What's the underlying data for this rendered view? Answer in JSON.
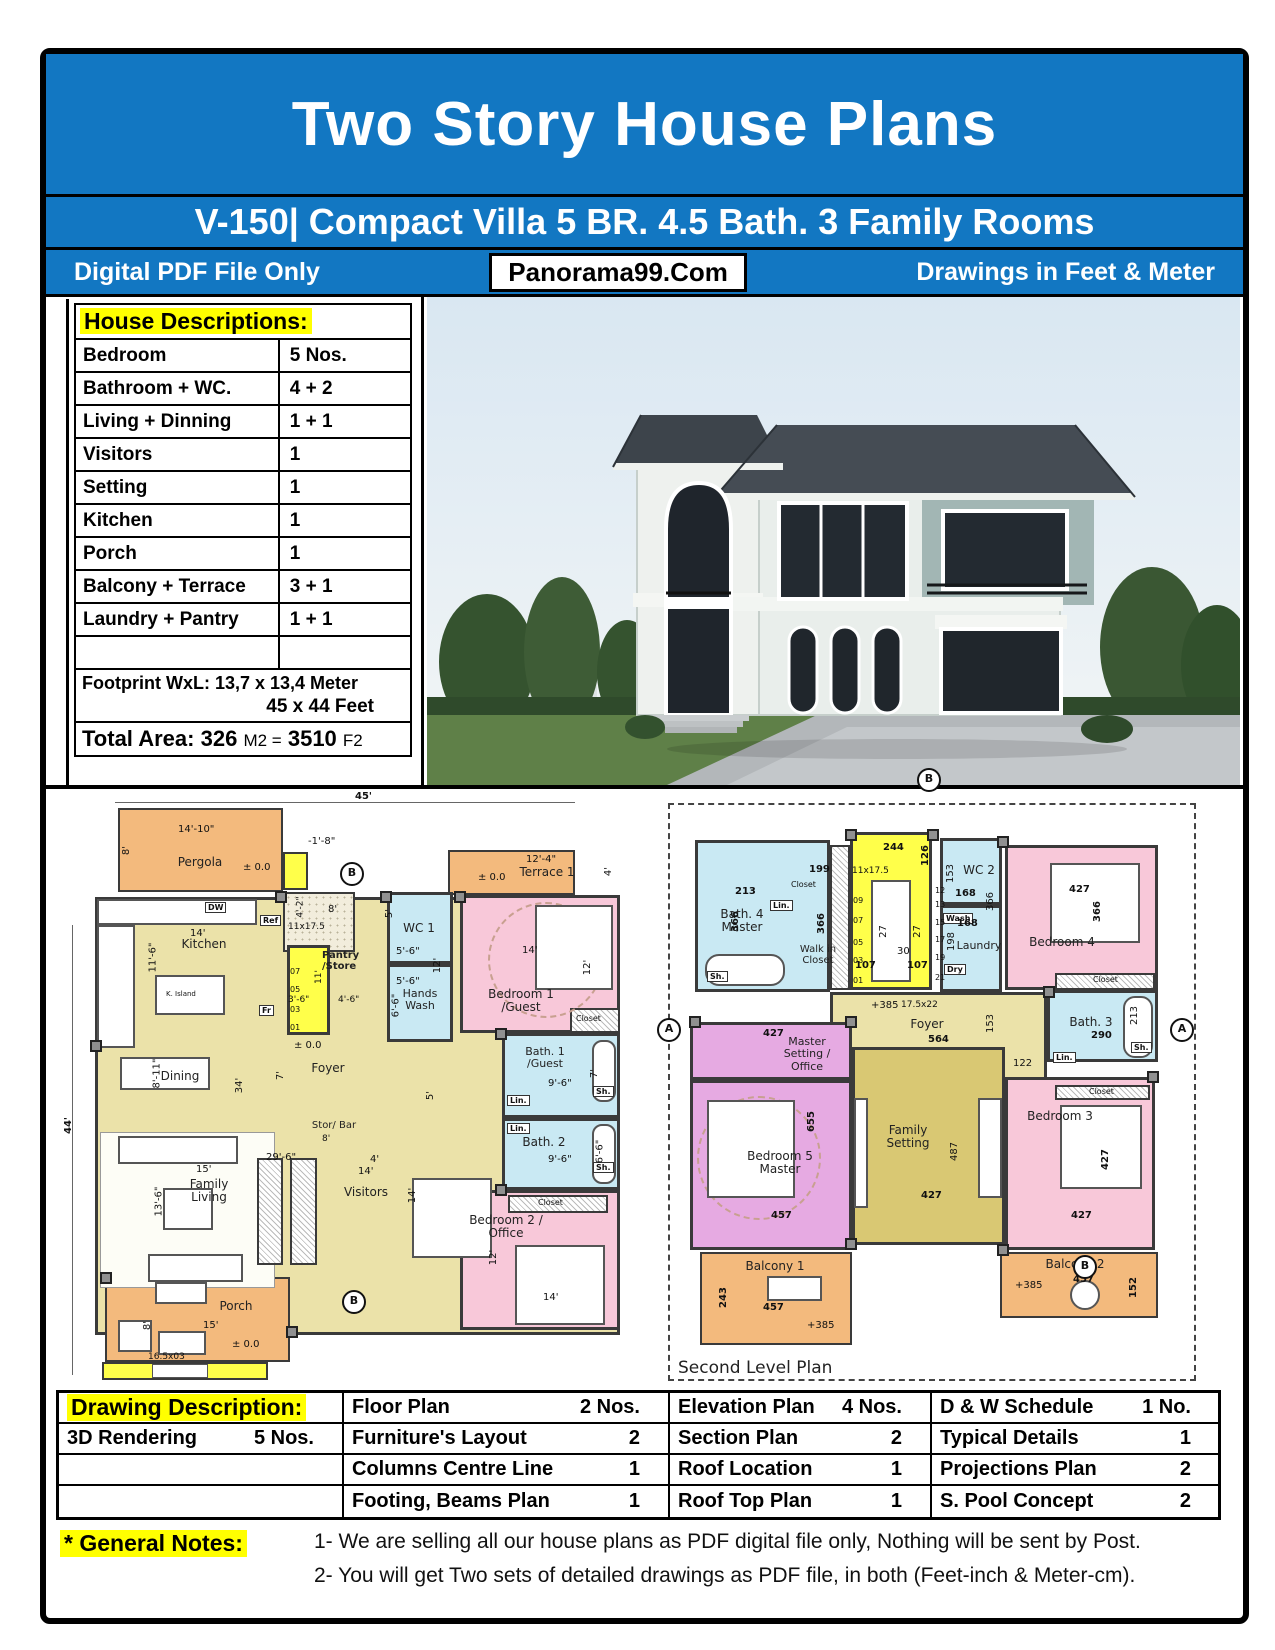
{
  "header": {
    "title": "Two Story House Plans",
    "subtitle": "V-150| Compact Villa 5 BR. 4.5 Bath. 3 Family Rooms",
    "left_note": "Digital PDF File Only",
    "site": "Panorama99.Com",
    "right_note": "Drawings in Feet & Meter"
  },
  "house": {
    "title": "House Descriptions:",
    "rows": [
      {
        "label": "Bedroom",
        "value": "5 Nos."
      },
      {
        "label": "Bathroom + WC.",
        "value": "4 + 2"
      },
      {
        "label": "Living + Dinning",
        "value": "1 + 1"
      },
      {
        "label": "Visitors",
        "value": "1"
      },
      {
        "label": "Setting",
        "value": "1"
      },
      {
        "label": "Kitchen",
        "value": "1"
      },
      {
        "label": "Porch",
        "value": "1"
      },
      {
        "label": "Balcony + Terrace",
        "value": "3  + 1"
      },
      {
        "label": "Laundry + Pantry",
        "value": "1  + 1"
      },
      {
        "label": "",
        "value": ""
      }
    ],
    "footprint_line1": "Footprint WxL: 13,7 x 13,4 Meter",
    "footprint_line2": "45 x 44 Feet",
    "total_label": "Total Area:",
    "total_m2": "326",
    "total_m2_unit": "M2 =",
    "total_f2": "3510",
    "total_f2_unit": "F2"
  },
  "drawing": {
    "title": "Drawing Description:",
    "rows": [
      {
        "c1l": "",
        "c1v": "",
        "c2l": "Floor Plan",
        "c2v": "2 Nos.",
        "c3l": "Elevation Plan",
        "c3v": "4 Nos.",
        "c4l": "D & W Schedule",
        "c4v": "1 No."
      },
      {
        "c1l": "3D Rendering",
        "c1v": "5 Nos.",
        "c2l": "Furniture's Layout",
        "c2v": "2",
        "c3l": "Section Plan",
        "c3v": "2",
        "c4l": "Typical Details",
        "c4v": "1"
      },
      {
        "c1l": "",
        "c1v": "",
        "c2l": "Columns Centre Line",
        "c2v": "1",
        "c3l": "Roof Location",
        "c3v": "1",
        "c4l": "Projections Plan",
        "c4v": "2"
      },
      {
        "c1l": "",
        "c1v": "",
        "c2l": "Footing, Beams Plan",
        "c2v": "1",
        "c3l": "Roof Top Plan",
        "c3v": "1",
        "c4l": "S. Pool Concept",
        "c4v": "2"
      }
    ]
  },
  "notes": {
    "title": "* General Notes:",
    "line1": "1- We are selling all our house plans as PDF digital file only, Nothing will be sent by Post.",
    "line2": "2- You will get Two sets of detailed drawings as PDF file, in both (Feet-inch & Meter-cm)."
  },
  "rooms1": {
    "pergola": "Pergola",
    "terrace": "Terrace 1",
    "kitchen": "Kitchen",
    "pantry": "Pantry /Store",
    "wc1": "WC 1",
    "hands": "Hands Wash",
    "bed1": "Bedroom 1 /Guest",
    "bath1": "Bath. 1 /Guest",
    "bath2": "Bath. 2",
    "foyer": "Foyer",
    "dining": "Dining",
    "family": "Family Living",
    "visitors": "Visitors",
    "storbar": "Stor/ Bar",
    "bed2": "Bedroom 2 / Office",
    "porch": "Porch"
  },
  "dims1": {
    "d45": "45'",
    "d44": "44'",
    "d1410": "14'-10\"",
    "pm0": "± 0.0",
    "d8": "8'",
    "dm18": "-1'-8\"",
    "d124": "12'-4\"",
    "d4": "4'",
    "d14": "14'",
    "d116": "11'-6\"",
    "s1117": "11x17.5",
    "d42": "4'-2\"",
    "d36": "3'-6\"",
    "d46": "4'-6\"",
    "d11": "11'",
    "d56": "5'-6\"",
    "d5": "5'",
    "d66": "6'-6\"",
    "d12": "12'",
    "d96": "9'-6\"",
    "d7": "7'",
    "d811": "8'-11\"",
    "d34": "34'",
    "d15": "15'",
    "d136": "13'-6\"",
    "d296": "29'-6\"",
    "d165": "16.5x03"
  },
  "rooms2": {
    "bath4": "Bath. 4 Master",
    "walkin": "Walk in Closet",
    "wc2": "WC 2",
    "laundry": "Laundry",
    "bed4": "Bedroom 4",
    "bath3": "Bath. 3",
    "foyer": "Foyer",
    "master": "Master Setting / Office",
    "bed5": "Bedroom 5 Master",
    "family": "Family Setting",
    "bed3": "Bedroom 3",
    "balc1": "Balcony 1",
    "balc2": "Balcony 2",
    "title": "Second Level Plan"
  },
  "dims2": {
    "d244": "244",
    "d126": "126",
    "s1117": "11x17.5",
    "d27": "27",
    "d30": "30",
    "d107": "107",
    "d199": "199",
    "d213": "213",
    "d366": "366",
    "d153": "153",
    "d168": "168",
    "d198": "198",
    "d427": "427",
    "d290": "290",
    "d564": "564",
    "p385": "+385",
    "s17522": "17.5x22",
    "d655": "655",
    "d457": "457",
    "d487": "487",
    "d122": "122",
    "d243": "243",
    "d152": "152"
  },
  "tags": {
    "lin": "Lin.",
    "sh": "Sh.",
    "closet": "Closet",
    "wash": "Wash",
    "dry": "Dry",
    "dw": "DW",
    "ref": "Ref",
    "fr": "Fr",
    "island": "K. Island"
  },
  "markers": {
    "a": "A",
    "b": "B"
  },
  "nums": {
    "n01": "01",
    "n03": "03",
    "n05": "05",
    "n07": "07",
    "n09": "09",
    "n12": "12",
    "n13": "13",
    "n15": "15",
    "n17": "17",
    "n19": "19",
    "n21": "21"
  },
  "colors": {
    "header_blue": "#1277c2",
    "highlight_yellow": "#ffff00",
    "room_khaki": "#ebe2a9",
    "room_pink": "#f8c8d9",
    "room_blue": "#c9e9f3",
    "room_orange": "#f3ba7d",
    "room_purple": "#e6aae2",
    "room_olive": "#d9c873",
    "stairs_yellow": "#ffff4a"
  }
}
